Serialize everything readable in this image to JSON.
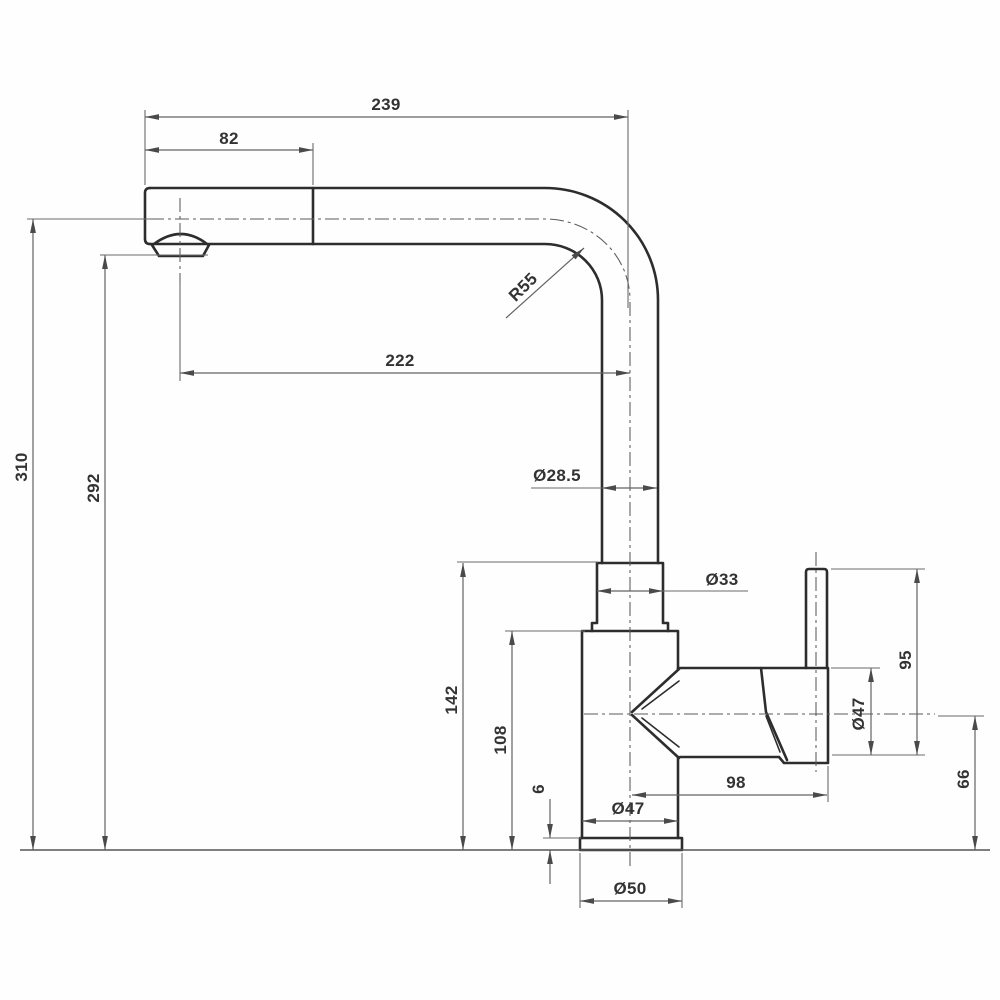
{
  "colors": {
    "background": "#fefefe",
    "outline": "#2d2d2d",
    "dimension_lines": "#636363",
    "text": "#333333"
  },
  "dims": {
    "d239": "239",
    "d82": "82",
    "d222": "222",
    "r55": "R55",
    "d310": "310",
    "d292": "292",
    "d28_5": "Ø28.5",
    "d33": "Ø33",
    "d142": "142",
    "d108": "108",
    "d6": "6",
    "d47_body": "Ø47",
    "d98": "98",
    "d95": "95",
    "d47_handle": "Ø47",
    "d66": "66",
    "d50": "Ø50"
  }
}
